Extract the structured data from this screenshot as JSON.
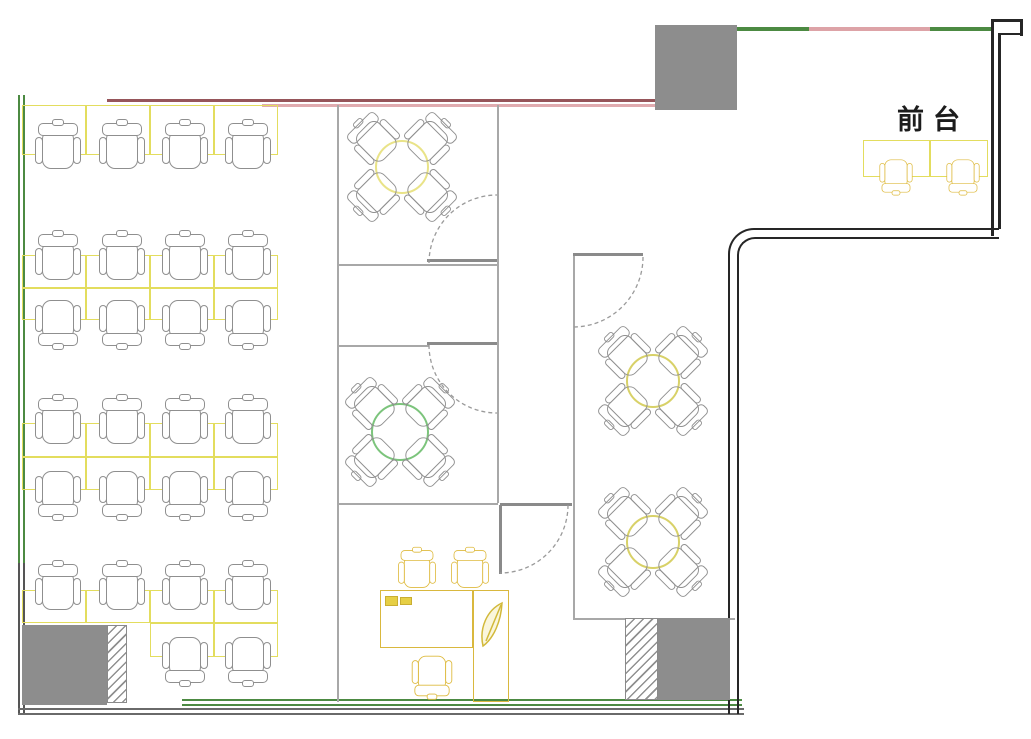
{
  "reception": {
    "label": "前台"
  },
  "colors": {
    "wall_green": "#4c8a42",
    "wall_gray_dark": "#555555",
    "wall_dark_red": "#96555a",
    "wall_pink": "#e0abaf",
    "wall_black": "#262626",
    "bottom_gray": "#6a6a6a",
    "interior_line": "#a8a8a8",
    "door_gray": "#8a8a8a",
    "column_gray": "#8d8d8d",
    "desk_yellow": "#e3dd5e",
    "office_yellow": "#d9b83e",
    "chair_gray": "#8f8f8f",
    "chair_yellow": "#deba3e",
    "table_pale_yellow": "#e9e388",
    "table_green": "#7cc47c",
    "table_yellow": "#d8d168"
  },
  "plan": {
    "walls": [
      [
        18,
        95,
        2,
        470,
        "#4c8a42",
        "left-wall-outer-green"
      ],
      [
        23,
        95,
        2,
        470,
        "#4c8a42",
        "left-wall-inner-green"
      ],
      [
        18,
        563,
        2,
        150,
        "#555555",
        "left-wall-outer-gray"
      ],
      [
        23,
        563,
        2,
        150,
        "#555555",
        "left-wall-inner-gray"
      ],
      [
        107,
        99,
        548,
        3,
        "#96555a",
        "top-wall-dark-red"
      ],
      [
        262,
        104,
        393,
        3,
        "#e0abaf",
        "top-wall-pink"
      ],
      [
        737,
        27,
        72,
        4,
        "#4c8a42",
        "top-wall-green-1"
      ],
      [
        809,
        27,
        121,
        4,
        "#dda3a7",
        "top-wall-pink-2"
      ],
      [
        930,
        27,
        61,
        4,
        "#4c8a42",
        "top-wall-green-2"
      ],
      [
        991,
        22,
        3,
        214,
        "#262626",
        "right-wall-outer"
      ],
      [
        998,
        33,
        3,
        196,
        "#262626",
        "right-wall-inner"
      ],
      [
        991,
        19,
        32,
        3,
        "#262626",
        "top-notch-top"
      ],
      [
        1020,
        19,
        3,
        17,
        "#262626",
        "top-notch-side"
      ],
      [
        998,
        33,
        25,
        2,
        "#262626",
        "top-notch-bottom"
      ],
      [
        18,
        708,
        726,
        2,
        "#6a6a6a",
        "bottom-wall-gray-outer"
      ],
      [
        18,
        713,
        726,
        2,
        "#6a6a6a",
        "bottom-wall-gray-inner"
      ],
      [
        182,
        699,
        560,
        2,
        "#4c8a42",
        "bottom-wall-green-1"
      ],
      [
        182,
        704,
        560,
        2,
        "#4c8a42",
        "bottom-wall-green-2"
      ]
    ],
    "corner_walls": [
      [
        728,
        228,
        271,
        486,
        "#262626",
        2.5,
        26,
        "corridor-return-wall-outer"
      ],
      [
        737,
        237,
        262,
        477,
        "#262626",
        2,
        18,
        "corridor-return-wall-inner"
      ]
    ],
    "interior_lines": [
      [
        337,
        105,
        2,
        597,
        "rooms-left-wall"
      ],
      [
        497,
        105,
        2,
        398,
        "rooms-right-wall"
      ],
      [
        337,
        264,
        160,
        2,
        "meeting-room-top-bottom-wall"
      ],
      [
        337,
        345,
        92,
        2,
        "meeting-room-mid-top-wall"
      ],
      [
        337,
        503,
        161,
        2,
        "office-top-wall"
      ],
      [
        573,
        255,
        2,
        363,
        "right-room-left-wall"
      ],
      [
        573,
        618,
        162,
        2,
        "right-room-bottom-wall"
      ]
    ],
    "door_leaves": [
      [
        427,
        259,
        70,
        2.5,
        "door-leaf-top-room"
      ],
      [
        427,
        342,
        70,
        2.5,
        "door-leaf-mid-room"
      ],
      [
        573,
        253,
        70,
        2.5,
        "door-leaf-right-room"
      ],
      [
        500,
        503,
        72,
        2.5,
        "door-header-office"
      ],
      [
        499,
        505,
        2.5,
        69,
        "door-leaf-office"
      ]
    ],
    "door_arcs": [
      [
        "M429,263 A68,68 0 0 1 497,195",
        "door-arc-top-room"
      ],
      [
        "M429,345 A68,68 0 0 0 497,413",
        "door-arc-mid-room"
      ],
      [
        "M643,257 A70,70 0 0 1 573,327",
        "door-arc-right-room"
      ],
      [
        "M568,505 A68,68 0 0 1 500,573",
        "door-arc-office"
      ]
    ],
    "columns": [
      [
        655,
        25,
        82,
        85,
        "column-top"
      ],
      [
        22,
        625,
        85,
        80,
        "column-bottom-left"
      ],
      [
        658,
        618,
        72,
        82,
        "column-bottom-right"
      ]
    ],
    "hatches": [
      [
        107,
        625,
        20,
        78,
        "shaft-hatch-left"
      ],
      [
        625,
        618,
        33,
        82,
        "shaft-hatch-right"
      ]
    ],
    "desks": [
      [
        22,
        105,
        64,
        50,
        "std"
      ],
      [
        86,
        105,
        64,
        50,
        "std"
      ],
      [
        150,
        105,
        64,
        50,
        "std"
      ],
      [
        214,
        105,
        64,
        50,
        "std"
      ],
      [
        22,
        255,
        64,
        33,
        "std"
      ],
      [
        86,
        255,
        64,
        33,
        "std"
      ],
      [
        150,
        255,
        64,
        33,
        "std"
      ],
      [
        214,
        255,
        64,
        33,
        "std"
      ],
      [
        22,
        288,
        64,
        32,
        "std"
      ],
      [
        86,
        288,
        64,
        32,
        "std"
      ],
      [
        150,
        288,
        64,
        32,
        "std"
      ],
      [
        214,
        288,
        64,
        32,
        "std"
      ],
      [
        22,
        423,
        64,
        34,
        "std"
      ],
      [
        86,
        423,
        64,
        34,
        "std"
      ],
      [
        150,
        423,
        64,
        34,
        "std"
      ],
      [
        214,
        423,
        64,
        34,
        "std"
      ],
      [
        22,
        457,
        64,
        33,
        "std"
      ],
      [
        86,
        457,
        64,
        33,
        "std"
      ],
      [
        150,
        457,
        64,
        33,
        "std"
      ],
      [
        214,
        457,
        64,
        33,
        "std"
      ],
      [
        22,
        590,
        64,
        33,
        "std"
      ],
      [
        86,
        590,
        64,
        33,
        "std"
      ],
      [
        150,
        590,
        64,
        33,
        "std"
      ],
      [
        214,
        590,
        64,
        33,
        "std"
      ],
      [
        150,
        623,
        64,
        34,
        "std"
      ],
      [
        214,
        623,
        64,
        34,
        "std"
      ],
      [
        863,
        140,
        67,
        37,
        "std"
      ],
      [
        930,
        140,
        58,
        37,
        "std"
      ],
      [
        380,
        590,
        93,
        58,
        "office"
      ],
      [
        473,
        590,
        36,
        112,
        "office"
      ]
    ],
    "computer_fills": [
      [
        385,
        596,
        13,
        10
      ],
      [
        400,
        597,
        12,
        8
      ]
    ],
    "tables": [
      [
        402,
        167,
        27,
        "#e9e388",
        "round-table-top-room"
      ],
      [
        400,
        432,
        29,
        "#7cc47c",
        "round-table-mid-room"
      ],
      [
        653,
        381,
        27,
        "#d8d168",
        "round-table-right-1"
      ],
      [
        653,
        542,
        27,
        "#d8d168",
        "round-table-right-2"
      ]
    ],
    "chairs": [
      [
        58,
        146,
        0,
        1,
        "g"
      ],
      [
        122,
        146,
        0,
        1,
        "g"
      ],
      [
        185,
        146,
        0,
        1,
        "g"
      ],
      [
        248,
        146,
        0,
        1,
        "g"
      ],
      [
        58,
        257,
        0,
        1,
        "g"
      ],
      [
        122,
        257,
        0,
        1,
        "g"
      ],
      [
        185,
        257,
        0,
        1,
        "g"
      ],
      [
        248,
        257,
        0,
        1,
        "g"
      ],
      [
        58,
        323,
        180,
        1,
        "g"
      ],
      [
        122,
        323,
        180,
        1,
        "g"
      ],
      [
        185,
        323,
        180,
        1,
        "g"
      ],
      [
        248,
        323,
        180,
        1,
        "g"
      ],
      [
        58,
        421,
        0,
        1,
        "g"
      ],
      [
        122,
        421,
        0,
        1,
        "g"
      ],
      [
        185,
        421,
        0,
        1,
        "g"
      ],
      [
        248,
        421,
        0,
        1,
        "g"
      ],
      [
        58,
        494,
        180,
        1,
        "g"
      ],
      [
        122,
        494,
        180,
        1,
        "g"
      ],
      [
        185,
        494,
        180,
        1,
        "g"
      ],
      [
        248,
        494,
        180,
        1,
        "g"
      ],
      [
        58,
        587,
        0,
        1,
        "g"
      ],
      [
        122,
        587,
        0,
        1,
        "g"
      ],
      [
        185,
        587,
        0,
        1,
        "g"
      ],
      [
        248,
        587,
        0,
        1,
        "g"
      ],
      [
        185,
        660,
        180,
        1,
        "g"
      ],
      [
        248,
        660,
        180,
        1,
        "g"
      ],
      [
        374,
        139,
        -45,
        0.95,
        "c"
      ],
      [
        430,
        139,
        45,
        0.95,
        "c"
      ],
      [
        374,
        195,
        -135,
        0.95,
        "c"
      ],
      [
        430,
        195,
        135,
        0.95,
        "c"
      ],
      [
        372,
        404,
        -45,
        0.95,
        "c"
      ],
      [
        428,
        404,
        45,
        0.95,
        "c"
      ],
      [
        372,
        460,
        -135,
        0.95,
        "c"
      ],
      [
        428,
        460,
        135,
        0.95,
        "c"
      ],
      [
        625,
        353,
        -45,
        0.95,
        "c"
      ],
      [
        681,
        353,
        45,
        0.95,
        "c"
      ],
      [
        625,
        409,
        -135,
        0.95,
        "c"
      ],
      [
        681,
        409,
        135,
        0.95,
        "c"
      ],
      [
        625,
        514,
        -45,
        0.95,
        "c"
      ],
      [
        681,
        514,
        45,
        0.95,
        "c"
      ],
      [
        625,
        570,
        -135,
        0.95,
        "c"
      ],
      [
        681,
        570,
        135,
        0.95,
        "c"
      ],
      [
        896,
        176,
        180,
        0.72,
        "y"
      ],
      [
        963,
        176,
        180,
        0.72,
        "y"
      ],
      [
        417,
        569,
        0,
        0.82,
        "y"
      ],
      [
        470,
        569,
        0,
        0.82,
        "y"
      ],
      [
        432,
        676,
        180,
        0.88,
        "y"
      ]
    ],
    "leaf": {
      "body": "M483,646 C479,628 487,610 502,603 C501,621 494,638 483,646 Z",
      "stem": "M486,641 L501,605"
    }
  }
}
